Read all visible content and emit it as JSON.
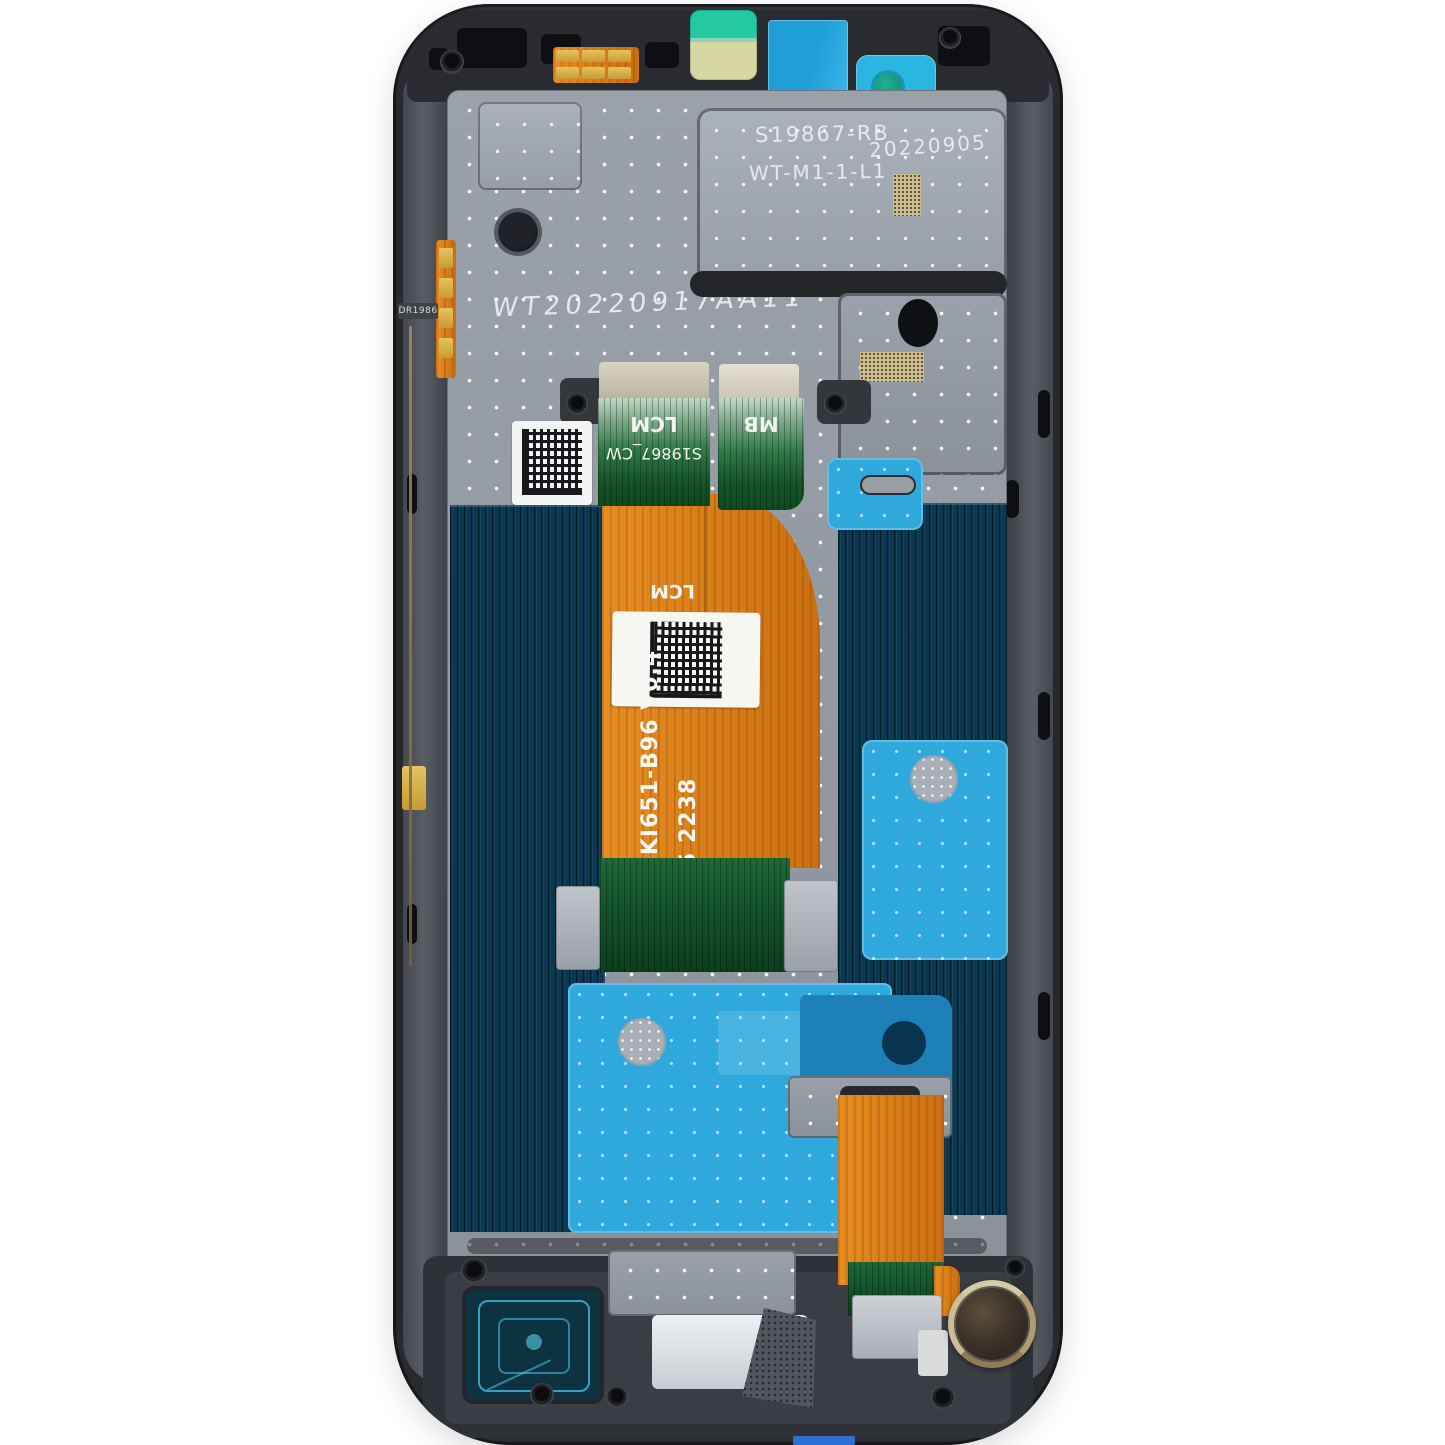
{
  "photo": {
    "subject": "Smartphone LCD display assembly with frame, internal rear view on white background",
    "markings": {
      "shield_line1": "S19867-RB",
      "shield_line2": "WT-M1-1-L1",
      "shield_date": "20220905",
      "handwritten": "WT20220917AA11",
      "connector_left": "LCM",
      "connector_left_id": "S19867_CW",
      "connector_right": "MB",
      "flex_center_label": "LCM",
      "flex_model": "SKI651-B96  V0.4",
      "flex_batch": "5 2238",
      "side_flex_id": "DR1986"
    },
    "colors": {
      "frame_dark": "#26282d",
      "metal_shield": "#989ea7",
      "lcd_navy": "#0b3850",
      "adhesive_cyan": "#2fa9dd",
      "adhesive_blue_dark": "#1d80b8",
      "flex_orange": "#e07c12",
      "flex_green": "#145327",
      "sticker_mint": "#24c8a2",
      "sticker_yellow": "#d7d7a3",
      "film_blue": "#1f9ed8",
      "motor_rim": "#d6c9a8"
    }
  }
}
